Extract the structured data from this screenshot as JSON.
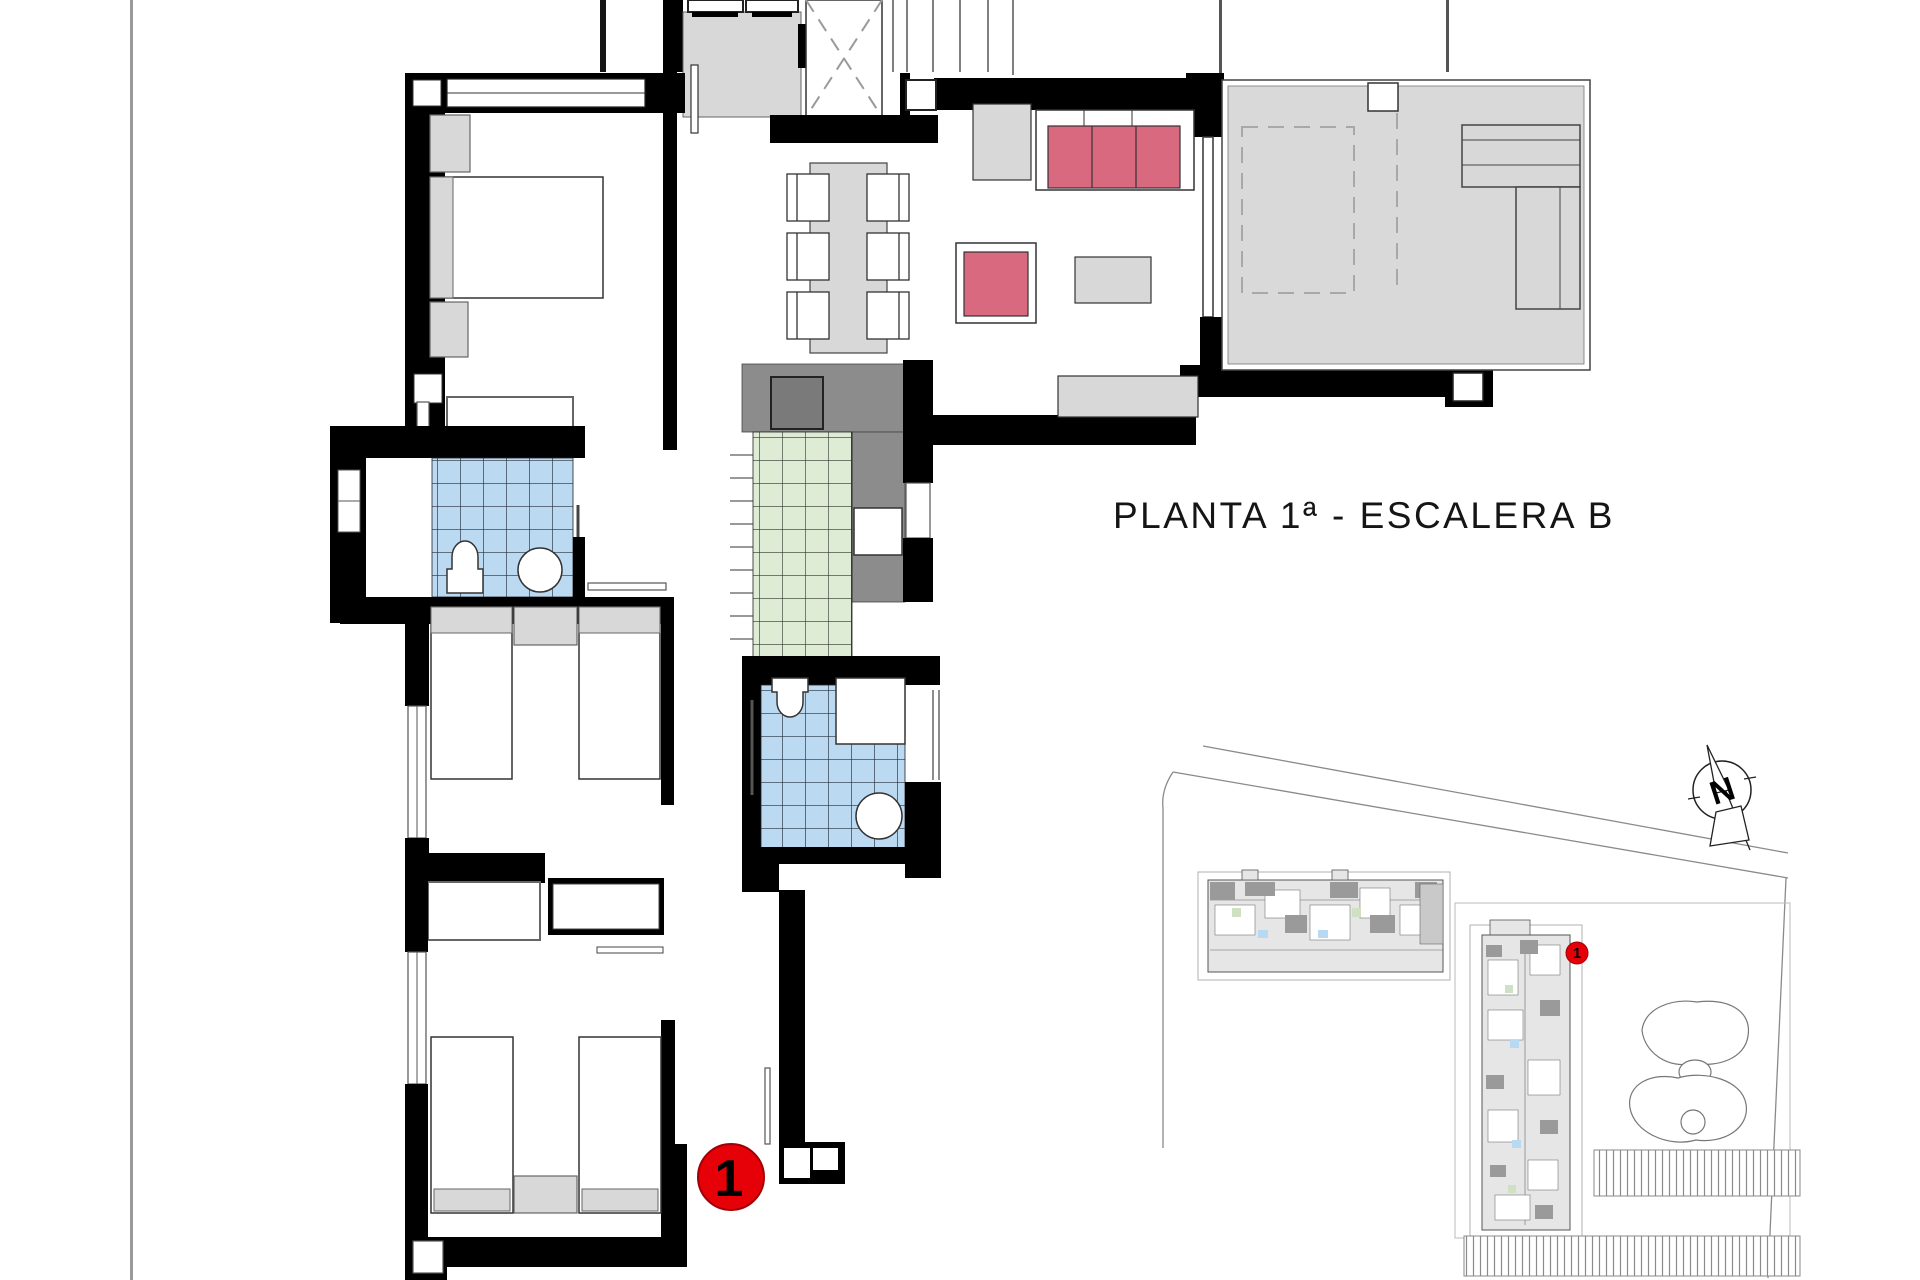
{
  "title": {
    "text": "PLANTA 1ª - ESCALERA B"
  },
  "unit_marker": {
    "label": "1"
  },
  "site_plan": {
    "marker_label": "1"
  },
  "compass": {
    "letter": "N"
  },
  "colors": {
    "wall": "#000000",
    "tile_blue": "#bcd9f2",
    "tile_green": "#dfecd5",
    "sofa_pink": "#d9697f",
    "furniture_gray": "#d8d8d8",
    "counter_gray": "#8c8c8c",
    "sink_gray": "#7a7a7a",
    "terrace_gray": "#d9d9d9",
    "marker_red": "#e60008",
    "line_gray": "#888888"
  }
}
